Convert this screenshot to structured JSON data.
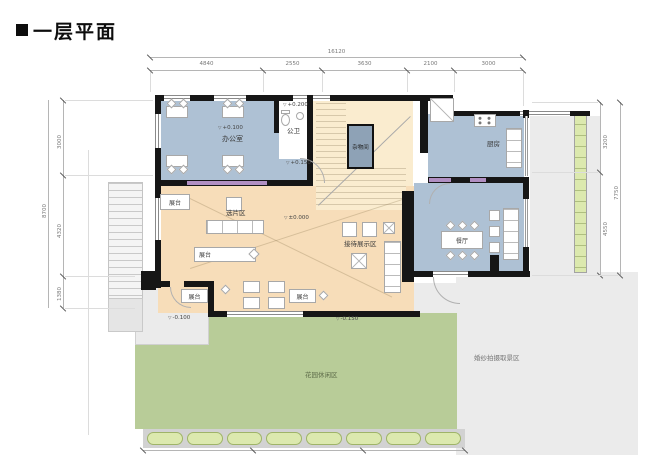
{
  "title": "一层平面",
  "dims": {
    "top": {
      "total": "16120",
      "segments": [
        "4840",
        "2550",
        "3630",
        "2100",
        "3000"
      ]
    },
    "left": {
      "total": "8700",
      "segments": [
        "3000",
        "4320",
        "1380"
      ]
    },
    "right": {
      "total": "7750",
      "segments": [
        "3200",
        "4550"
      ]
    }
  },
  "rooms": {
    "office": "办公室",
    "public_wc": "公卫",
    "storage": "杂物间",
    "kitchen": "厨房",
    "dining": "餐厅",
    "selection_area": "选片区",
    "reception_display": "接待展示区",
    "stage": "展台",
    "garden": "花园休闲区",
    "photo_zone": "婚纱拍摄取景区"
  },
  "elevations": {
    "office": "+0.100",
    "public_wc": "+0.200",
    "landing": "+0.150",
    "hall": "±0.000",
    "terrace": "-0.100",
    "garden": "-0.150"
  },
  "colors": {
    "wall": "#161616",
    "room-blue": "#aec1d4",
    "hall-tan": "#f7ddb9",
    "stair-tan": "#faeccf",
    "storage-blue": "#8ea2b6",
    "garden-green": "#b8cc98",
    "hedge-green": "#dce9ae",
    "paving-gray": "#ebebeb",
    "door-purple": "#b18fc2"
  }
}
